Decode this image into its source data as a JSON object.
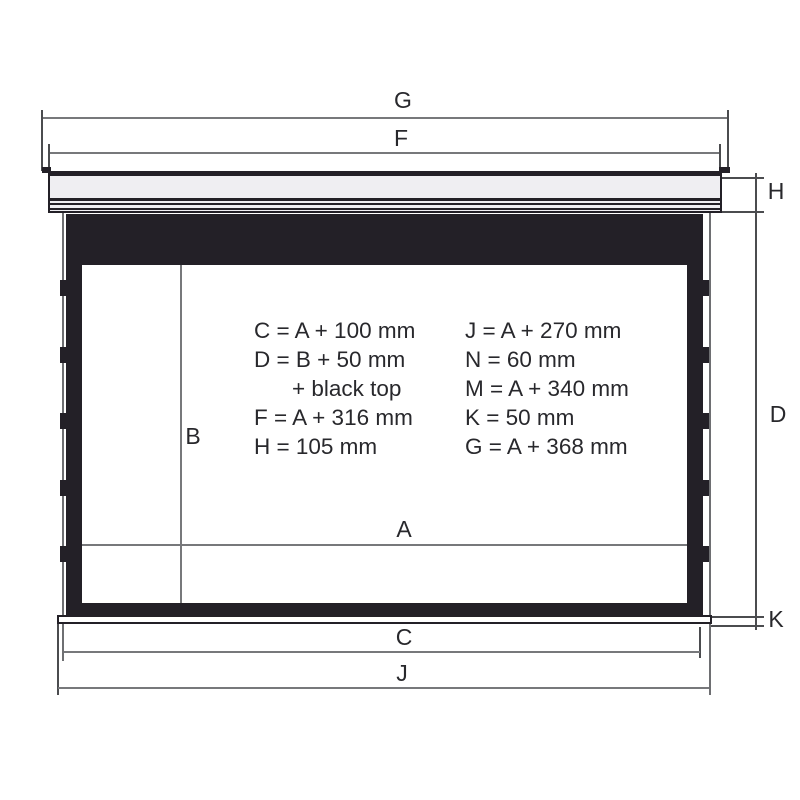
{
  "labels": {
    "G": "G",
    "F": "F",
    "H": "H",
    "D": "D",
    "K": "K",
    "C": "C",
    "J": "J",
    "A": "A",
    "B": "B"
  },
  "formulas": {
    "left": [
      "C = A + 100 mm",
      "D = B + 50 mm",
      "+ black top",
      "F = A + 316 mm",
      "H = 105 mm"
    ],
    "right": [
      "J = A + 270 mm",
      "N = 60 mm",
      "M = A + 340 mm",
      "K = 50 mm",
      "G = A + 368 mm"
    ]
  },
  "colors": {
    "frame_black": "#232027",
    "casing_fill": "#efeef2",
    "dimension_line": "#77787b",
    "extension_line": "#4b4c4f",
    "text": "#28282c",
    "background": "#ffffff"
  }
}
